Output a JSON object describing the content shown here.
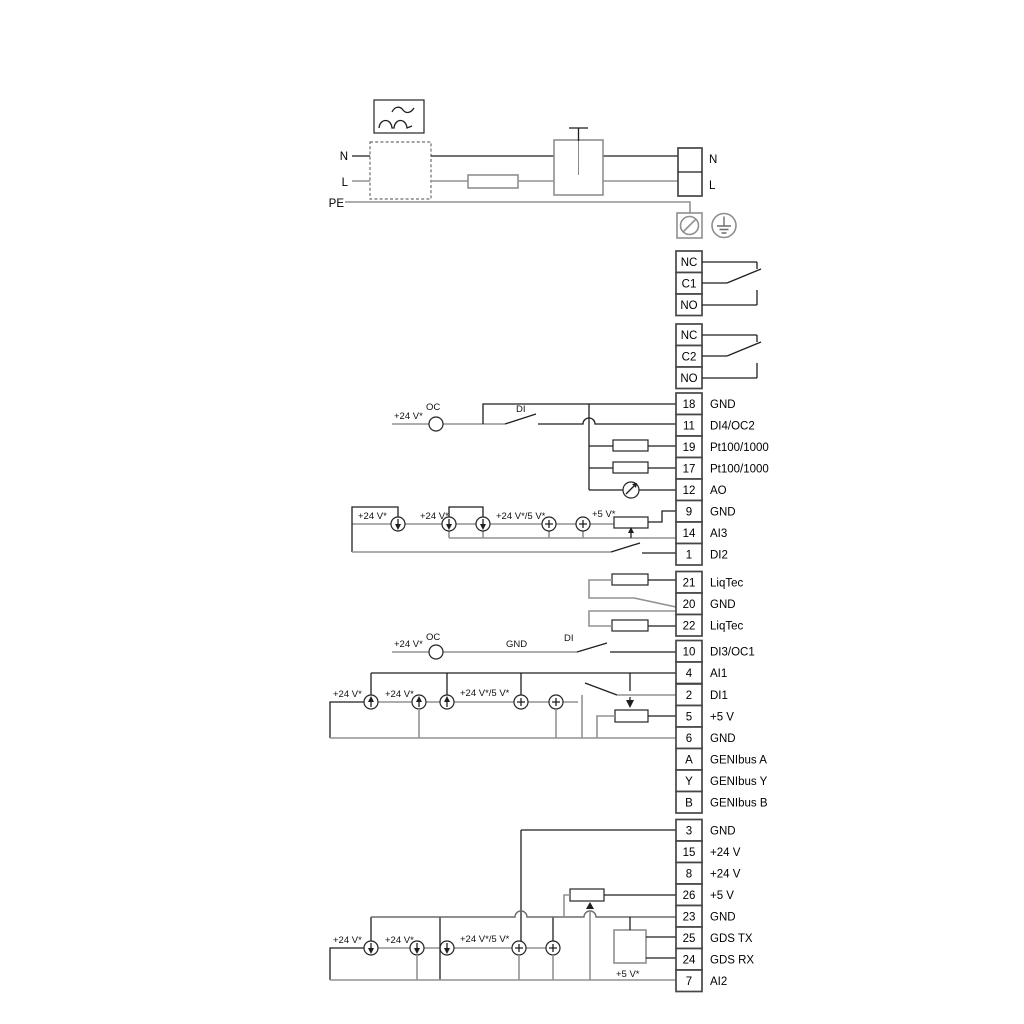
{
  "power": {
    "n_in": "N",
    "l_in": "L",
    "pe": "PE",
    "n_out": "N",
    "l_out": "L"
  },
  "relay1": {
    "nc": "NC",
    "common": "C1",
    "no": "NO"
  },
  "relay2": {
    "nc": "NC",
    "common": "C2",
    "no": "NO"
  },
  "labels": {
    "v24": "+24 V*",
    "v24v5": "+24 V*/5 V*",
    "v5": "+5 V*",
    "oc": "OC",
    "di": "DI",
    "gnd": "GND"
  },
  "terminals": [
    {
      "id": "18",
      "label": "GND"
    },
    {
      "id": "11",
      "label": "DI4/OC2"
    },
    {
      "id": "19",
      "label": "Pt100/1000"
    },
    {
      "id": "17",
      "label": "Pt100/1000"
    },
    {
      "id": "12",
      "label": "AO"
    },
    {
      "id": "9",
      "label": "GND"
    },
    {
      "id": "14",
      "label": "AI3"
    },
    {
      "id": "1",
      "label": "DI2"
    },
    {
      "id": "21",
      "label": "LiqTec"
    },
    {
      "id": "20",
      "label": "GND"
    },
    {
      "id": "22",
      "label": "LiqTec"
    },
    {
      "id": "10",
      "label": "DI3/OC1"
    },
    {
      "id": "4",
      "label": "AI1"
    },
    {
      "id": "2",
      "label": "DI1"
    },
    {
      "id": "5",
      "label": "+5 V"
    },
    {
      "id": "6",
      "label": "GND"
    },
    {
      "id": "A",
      "label": "GENIbus A"
    },
    {
      "id": "Y",
      "label": "GENIbus Y"
    },
    {
      "id": "B",
      "label": "GENIbus B"
    },
    {
      "id": "3",
      "label": "GND"
    },
    {
      "id": "15",
      "label": "+24 V"
    },
    {
      "id": "8",
      "label": "+24 V"
    },
    {
      "id": "26",
      "label": "+5 V"
    },
    {
      "id": "23",
      "label": "GND"
    },
    {
      "id": "25",
      "label": "GDS TX"
    },
    {
      "id": "24",
      "label": "GDS RX"
    },
    {
      "id": "7",
      "label": "AI2"
    }
  ]
}
